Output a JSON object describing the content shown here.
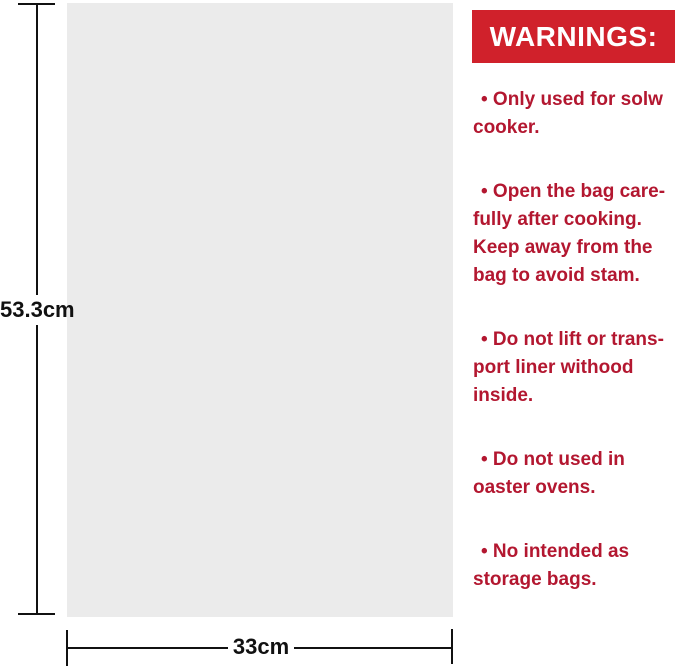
{
  "diagram": {
    "height_label": "53.3cm",
    "width_label": "33cm"
  },
  "warnings": {
    "title": "WARNINGS:",
    "items": [
      "• Only used for solw\ncooker.",
      "• Open the bag care-\nfully after cooking.\nKeep away from the\nbag to avoid stam.",
      "• Do not lift or trans-\nport liner withood\ninside.",
      "• Do not used in\noaster ovens.",
      "• No intended as\nstorage bags."
    ]
  },
  "colors": {
    "banner_red": "#D0212B",
    "text_red": "#B31730",
    "bag_gray": "#EBEBEB",
    "dim_color": "#111111"
  }
}
